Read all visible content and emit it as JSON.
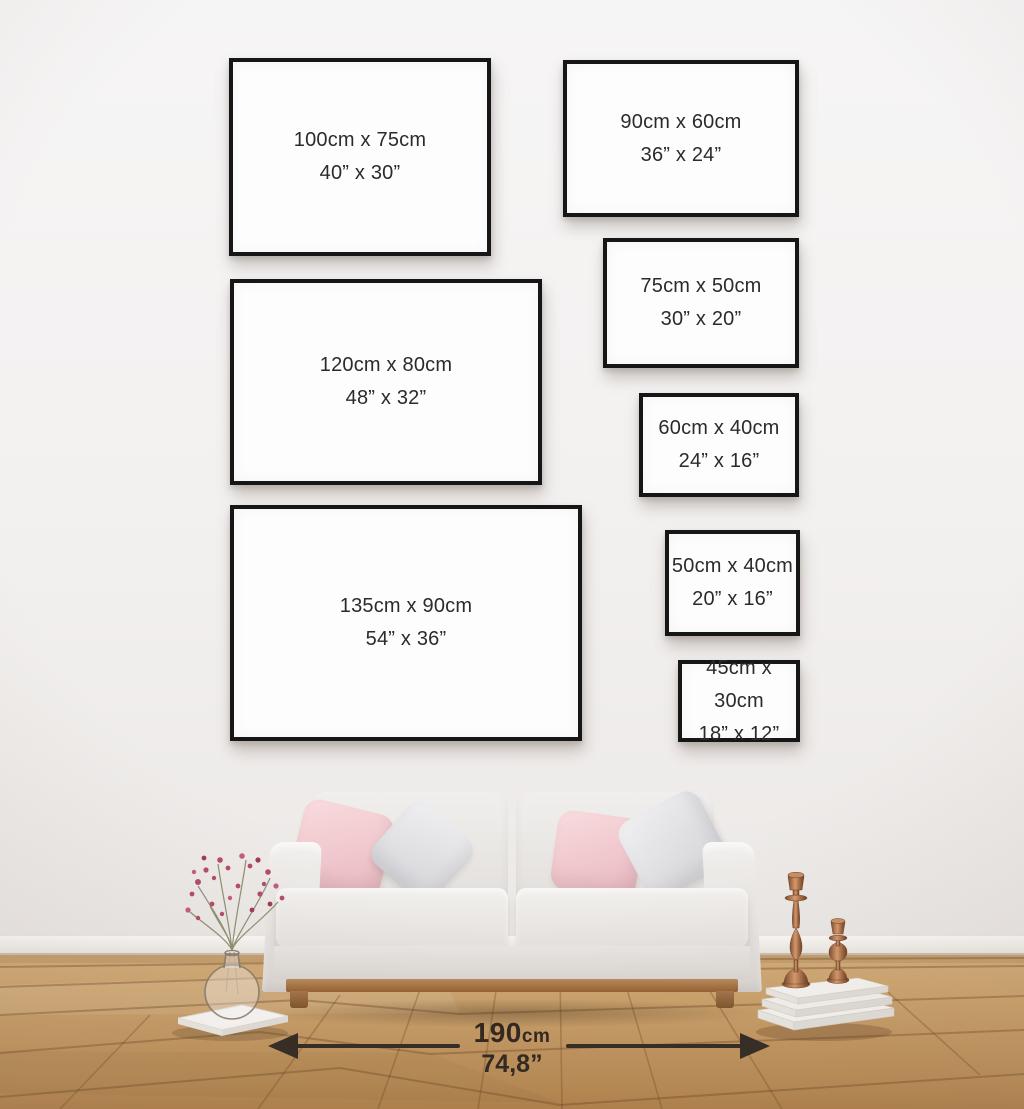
{
  "title": "Poster frame size guide wall mockup",
  "frames": [
    {
      "name": "100x75",
      "cm": "100cm x 75cm",
      "inches": "40” x 30”"
    },
    {
      "name": "90x60",
      "cm": "90cm x 60cm",
      "inches": "36” x 24”"
    },
    {
      "name": "120x80",
      "cm": "120cm x 80cm",
      "inches": "48” x 32”"
    },
    {
      "name": "75x50",
      "cm": "75cm x 50cm",
      "inches": "30” x 20”"
    },
    {
      "name": "60x40",
      "cm": "60cm x 40cm",
      "inches": "24” x 16”"
    },
    {
      "name": "135x90",
      "cm": "135cm x 90cm",
      "inches": "54” x 36”"
    },
    {
      "name": "50x40",
      "cm": "50cm x 40cm",
      "inches": "20” x 16”"
    },
    {
      "name": "45x30",
      "cm": "45cm x 30cm",
      "inches": "18” x 12”"
    }
  ],
  "measurement": {
    "value": "190",
    "unit": "cm",
    "inches": "74,8”"
  },
  "palette": {
    "wall": "#f3f1f0",
    "frame_border": "#161616",
    "label_text": "#2b2b2b",
    "arrow_color": "#2e2720",
    "floor_wood": "#c2955e",
    "sofa_fabric": "#eceae8",
    "pillow_pink": "#ecc0c7",
    "pillow_gray": "#d8d8dc",
    "wood_leg": "#a6754a",
    "copper": "#b5714f",
    "flower": "#b34a6c"
  }
}
